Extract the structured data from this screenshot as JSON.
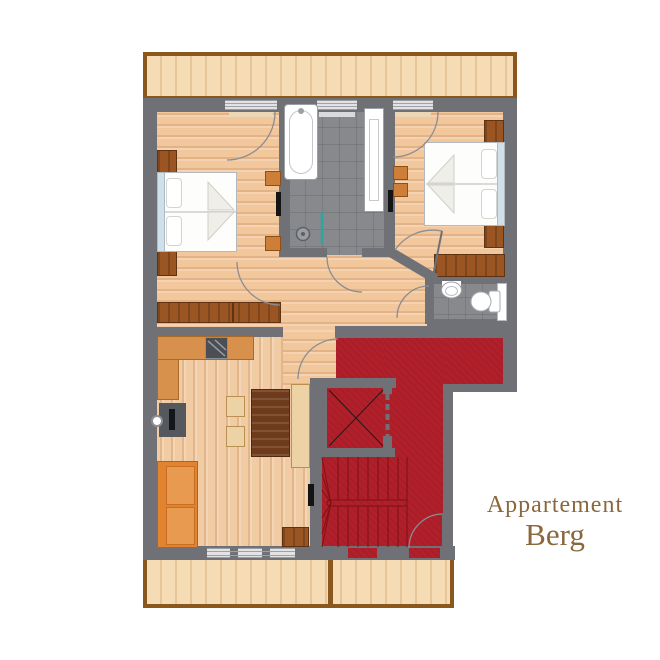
{
  "title": {
    "line1": "Appartement",
    "line2": "Berg"
  },
  "plan": {
    "type": "apartment-floor-plan",
    "rooms": [
      {
        "name": "balcony-top",
        "furniture": []
      },
      {
        "name": "bedroom-left",
        "furniture": [
          "double-bed",
          "nightstand",
          "nightstand",
          "sideboard",
          "stool",
          "stool",
          "radiator",
          "balcony-door",
          "window"
        ]
      },
      {
        "name": "bathroom",
        "furniture": [
          "bathtub",
          "vanity-counter",
          "shower-drain",
          "shower-screen",
          "window",
          "door"
        ]
      },
      {
        "name": "bedroom-right",
        "furniture": [
          "double-bed",
          "nightstand",
          "nightstand",
          "bench",
          "stool",
          "stool",
          "balcony-door",
          "diagonal-door"
        ]
      },
      {
        "name": "wc",
        "furniture": [
          "toilet",
          "hand-basin",
          "door"
        ]
      },
      {
        "name": "living-kitchen",
        "furniture": [
          "kitchen-counter",
          "stove",
          "kitchen-sink",
          "dining-table",
          "chair",
          "chair",
          "dining-bench",
          "sofa",
          "cabinet",
          "radiator",
          "window"
        ]
      },
      {
        "name": "stairwell",
        "furniture": [
          "winder-staircase",
          "elevator",
          "entry-door",
          "exit-door"
        ]
      },
      {
        "name": "balcony-bottom",
        "furniture": []
      }
    ],
    "colors": {
      "wall": "#6f7176",
      "wood_floor": "#f2c79c",
      "balcony_wood": "#f6dcb4",
      "balcony_rail": "#8a571c",
      "bath_tile": "#87898d",
      "stair_carpet": "#b1202a",
      "furniture_brown": "#9a5523",
      "kitchen_counter": "#d8914c",
      "sofa_orange": "#e2832f",
      "table_walnut": "#6e3b1d",
      "bed_linen": "#ffffff",
      "headboard_blue": "#cfe0ea",
      "shower_screen": "#2fa3a0",
      "title_text": "#8a683c"
    }
  }
}
